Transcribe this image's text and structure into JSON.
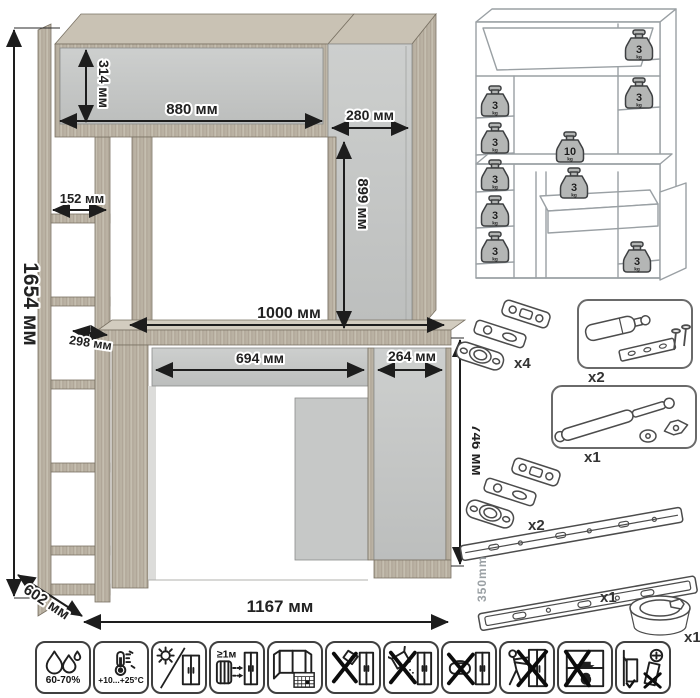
{
  "main_drawing": {
    "unit": "мм",
    "dimensions": {
      "total_height": "1654 мм",
      "hutch_height": "314 мм",
      "hutch_width": "880 мм",
      "top_right_width": "280 мм",
      "right_column_height": "899 мм",
      "shelf_inner_width": "152 мм",
      "shelf_depth": "298 мм",
      "desktop_width": "1000 мм",
      "drawer_width": "694 мм",
      "door_width": "264 мм",
      "desk_height": "746 мм",
      "depth": "602 мм",
      "total_width": "1167 мм"
    },
    "colors": {
      "wood": "#b8b0a1",
      "panel": "#c8cac9",
      "dimension": "#1d1d1d"
    }
  },
  "load_schematic": {
    "unit_label": "kg",
    "weights": [
      {
        "value": "3",
        "location": "hutch-right-shelf"
      },
      {
        "value": "3",
        "location": "right-column-shelf"
      },
      {
        "value": "3",
        "location": "left-shelf-1"
      },
      {
        "value": "3",
        "location": "left-shelf-2"
      },
      {
        "value": "3",
        "location": "left-shelf-3"
      },
      {
        "value": "3",
        "location": "left-shelf-4"
      },
      {
        "value": "3",
        "location": "left-shelf-5"
      },
      {
        "value": "10",
        "location": "desktop"
      },
      {
        "value": "3",
        "location": "drawer"
      },
      {
        "value": "3",
        "location": "base-cabinet"
      }
    ]
  },
  "hardware": {
    "hinge_set_top": {
      "qty": "x4"
    },
    "door_damper": {
      "qty": "x2"
    },
    "gas_lift": {
      "qty": "x1"
    },
    "hinge_set_bottom": {
      "qty": "x2"
    },
    "drawer_slides": {
      "qty": "x1",
      "length": "350mm"
    },
    "cable_grommet": {
      "qty": "x1"
    }
  },
  "care_icons": [
    {
      "name": "humidity-range",
      "label": "60-70%"
    },
    {
      "name": "temperature-range",
      "label": "+10...+25°C"
    },
    {
      "name": "avoid-direct-sunlight"
    },
    {
      "name": "min-distance-from-heat",
      "label": "≥1м"
    },
    {
      "name": "ventilate-room"
    },
    {
      "name": "no-impact-tools"
    },
    {
      "name": "no-abrasive-cleaners"
    },
    {
      "name": "no-wet-cleaning"
    },
    {
      "name": "do-not-drag"
    },
    {
      "name": "do-not-overload"
    },
    {
      "name": "anchor-to-wall"
    }
  ]
}
